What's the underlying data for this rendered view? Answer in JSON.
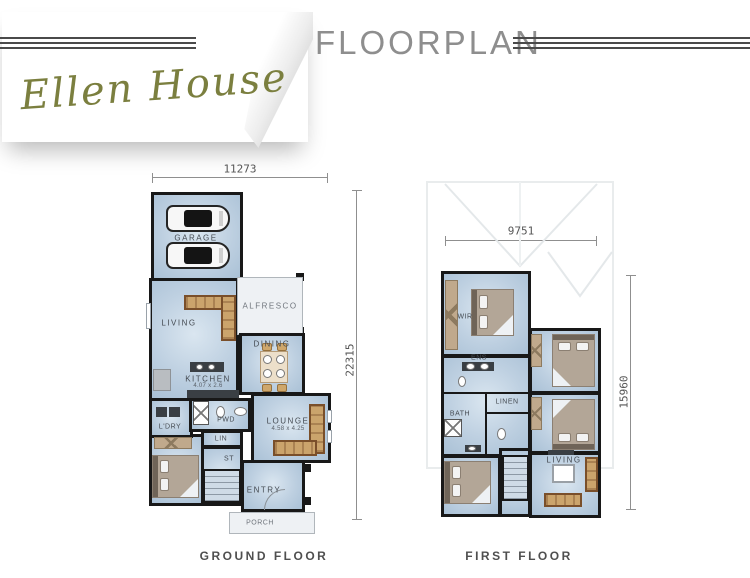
{
  "header": {
    "brand_script": "Ellen House",
    "title": "FLOORPLAN"
  },
  "ground_floor": {
    "caption": "GROUND FLOOR",
    "dim_width": "11273",
    "dim_height": "22315",
    "labels": {
      "garage": "GARAGE",
      "living": "LIVING",
      "alfresco": "ALFRESCO",
      "dining": "DINING",
      "kitchen": "KITCHEN",
      "kitchen_size": "4.07 x 2.6",
      "laundry": "L'DRY",
      "powder": "PWD",
      "lounge": "LOUNGE",
      "lounge_size": "4.58 x 4.25",
      "linen": "LIN",
      "store": "ST",
      "entry": "ENTRY",
      "porch": "PORCH"
    }
  },
  "first_floor": {
    "caption": "FIRST FLOOR",
    "dim_width": "9751",
    "dim_height": "15960",
    "labels": {
      "wir": "WIR",
      "ensuite": "ENS",
      "linen": "LINEN",
      "bath": "BATH",
      "living": "LIVING"
    }
  },
  "colors": {
    "brand_olive": "#7b7f3f",
    "title_gray": "#8e8e8e",
    "floor_blue": "#bed0e1",
    "wall_black": "#181818",
    "furniture_tan": "#cba46c",
    "outdoor_floor": "#eef1f4",
    "dimension_gray": "#8f8f8f"
  }
}
